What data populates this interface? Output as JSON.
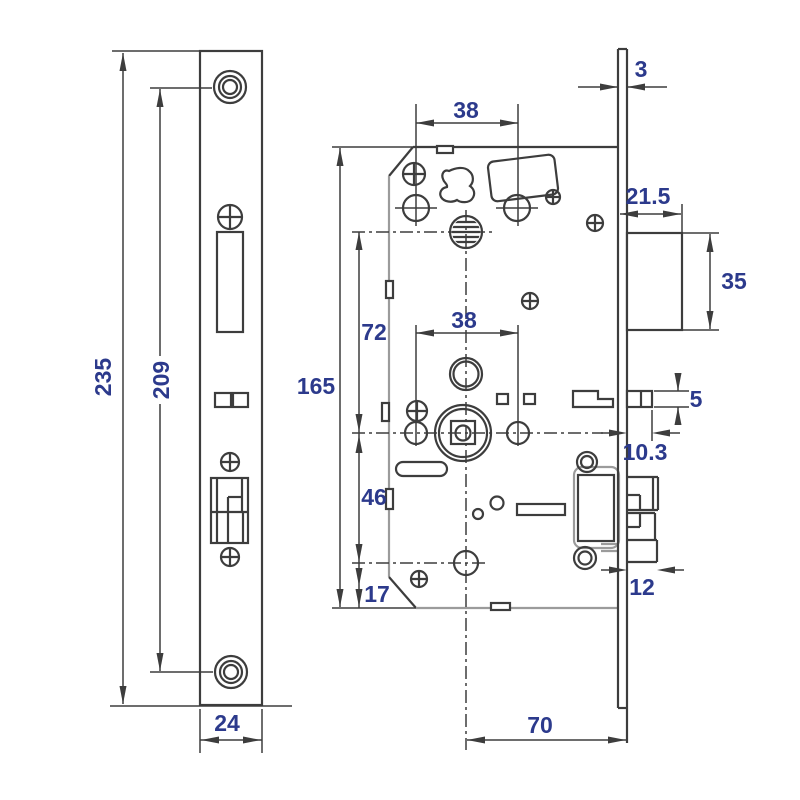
{
  "drawing": {
    "title": "Mortise lock dimensional drawing",
    "unit": "mm",
    "dims": {
      "faceplate_height": "235",
      "screw_centers": "209",
      "faceplate_width": "24",
      "faceplate_thickness": "3",
      "top_hole_spacing": "38",
      "hub_hole_spacing": "38",
      "latch_protrusion": "21.5",
      "latch_height": "35",
      "case_height": "165",
      "top_to_hub": "72",
      "hub_to_cylinder": "46",
      "cylinder_to_bottom": "17",
      "deadlatch_height": "5",
      "deadlatch_protrusion": "10.3",
      "deadbolt_throw": "12",
      "backset": "70"
    },
    "colors": {
      "line": "#3d3d3d",
      "line_light": "#9b9b9b",
      "dim_text": "#2c3a8c",
      "bg": "#ffffff"
    }
  }
}
